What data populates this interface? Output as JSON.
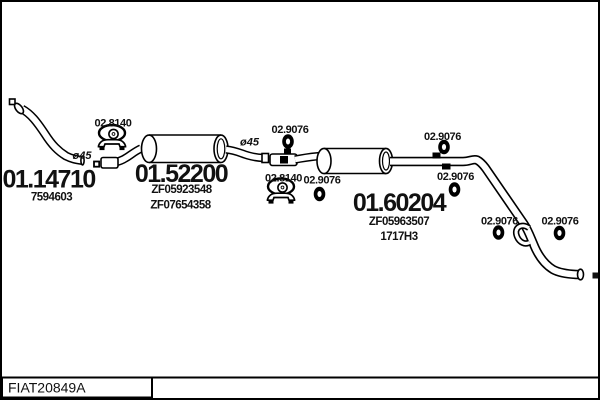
{
  "frame": {
    "background": "#ffffff",
    "line_color": "#000000"
  },
  "footer": {
    "drawing_id": "FIAT20849A"
  },
  "labels": {
    "clamp": "02.8140",
    "hanger_ring": "02.9076"
  },
  "parts": {
    "front_pipe": {
      "number": "01.14710",
      "oe_ref": "7594603",
      "diameter_label": "ø45"
    },
    "centre_muffler": {
      "number": "01.52200",
      "oe_refs": [
        "ZF05923548",
        "ZF07654358"
      ],
      "diameter_label": "ø45"
    },
    "rear_muffler": {
      "number": "01.60204",
      "oe_refs": [
        "ZF05963507",
        "1717H3"
      ]
    }
  }
}
